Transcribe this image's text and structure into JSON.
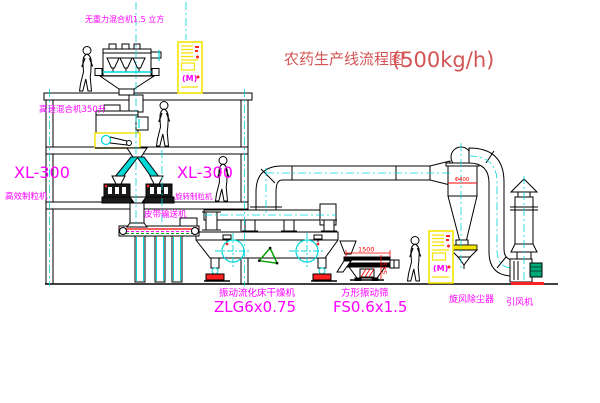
{
  "title": {
    "text": "农药生产线流程图",
    "capacity": "(500kg/h)"
  },
  "labels": {
    "no_gravity_mixer": "无重力混合机1.5 立方",
    "high_speed_mixer": "高速混合机350升",
    "granulator_left_model": "XL-300",
    "granulator_left_name": "高效制粒机",
    "granulator_right_model": "XL-300",
    "granulator_right_name": "旋转制粒机",
    "belt_conveyor": "皮带输送机",
    "dryer_name": "振动流化床干燥机",
    "dryer_model": "ZLG6x0.75",
    "sieve_name": "方形振动筛",
    "sieve_model": "FS0.6x1.5",
    "cyclone": "旋风除尘器",
    "fan": "引风机"
  },
  "dimensions": {
    "sieve_length": "1500",
    "sieve_height": "545",
    "cyclone_diameter": "Φ400"
  },
  "cabinet": {
    "panel_symbol": "(M)"
  },
  "colors": {
    "label_magenta": "#ff00ff",
    "title_red": "#d35454",
    "dimension_red": "#ff0000",
    "centerline_cyan": "#00d8d8",
    "cabinet_yellow": "#f5e400",
    "machine_foot_red": "#ff2020",
    "motor_green": "#00aa77",
    "recycle_green": "#00a000"
  }
}
